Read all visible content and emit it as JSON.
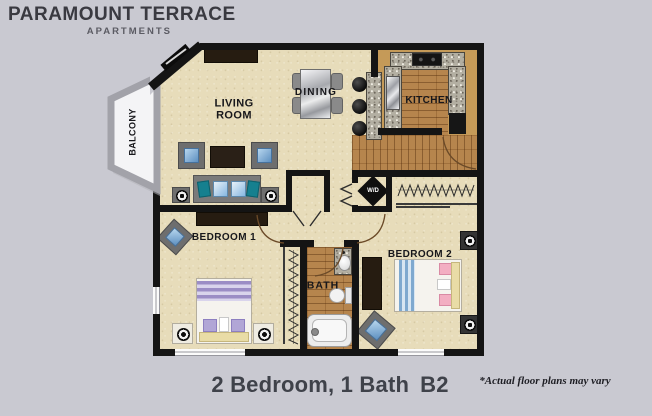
{
  "header": {
    "brand": "PARAMOUNT TERRACE",
    "sub": "APARTMENTS"
  },
  "rooms": {
    "living": {
      "line1": "LIVING",
      "line2": "ROOM"
    },
    "dining": "DINING",
    "kitchen": "KITCHEN",
    "balcony": "BALCONY",
    "bedroom1": "BEDROOM 1",
    "bath": "BATH",
    "bedroom2": "BEDROOM 2",
    "wd": "W/D"
  },
  "caption": {
    "title": "2 Bedroom, 1 Bath",
    "code": "B2",
    "disclaimer": "*Actual floor plans may vary"
  },
  "colors": {
    "background": "#c9c9d1",
    "wall": "#141414",
    "floor": "#e7dcba",
    "kitchen": "#c59a58",
    "granite": "#b3afa2",
    "wood": "#b6854d",
    "label": "#17171b",
    "caption": "#3f424a",
    "accent_blue": "#86b7e0",
    "accent_teal": "#15808f",
    "bed1_purple": "#9b8dc5",
    "bed2_blue": "#7fa9cf",
    "pillow_pink": "#f3aec2",
    "bench_cream": "#e9dca6"
  }
}
